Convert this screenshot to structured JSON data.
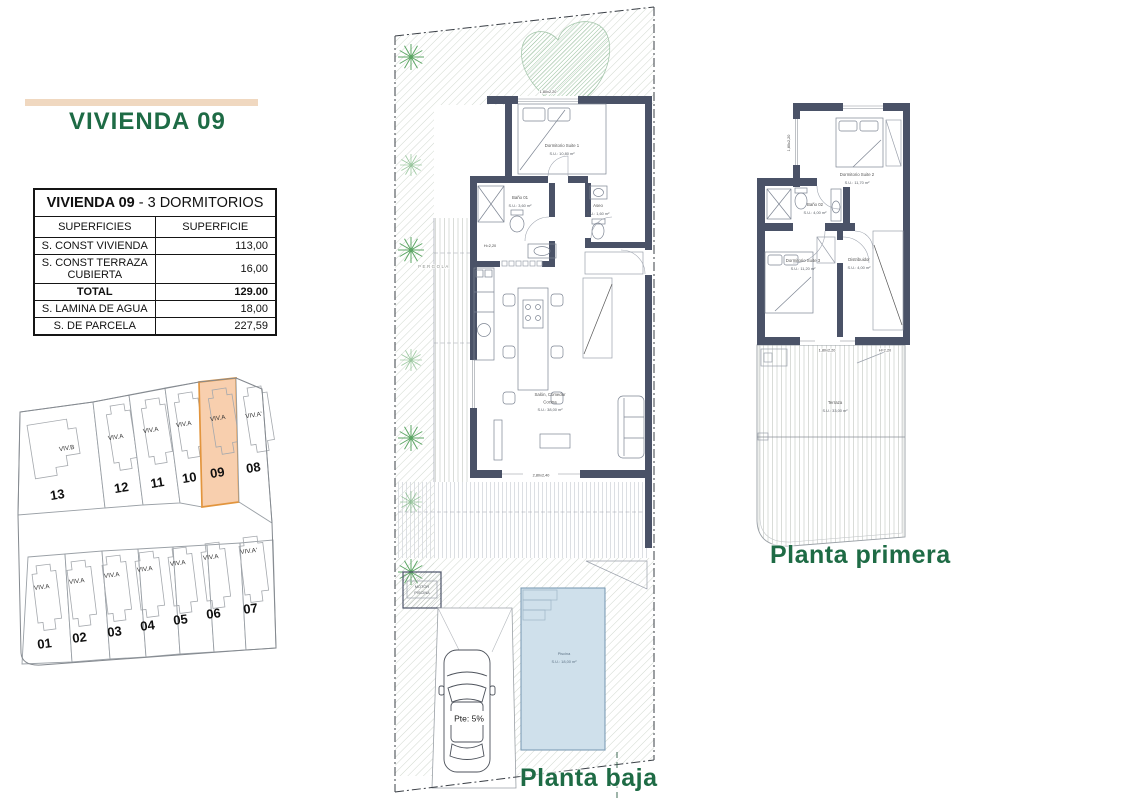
{
  "header": {
    "title": "VIVIENDA 09"
  },
  "table": {
    "title": {
      "bold": "VIVIENDA 09",
      "rest": " - 3 DORMITORIOS"
    },
    "columns": [
      "SUPERFICIES",
      "SUPERFICIE"
    ],
    "rows": [
      {
        "label": "S. CONST VIVIENDA",
        "value": "113,00",
        "bold": false
      },
      {
        "label": "S. CONST TERRAZA CUBIERTA",
        "value": "16,00",
        "bold": false
      },
      {
        "label": "TOTAL",
        "value": "129.00",
        "bold": true
      },
      {
        "label": "S. LAMINA DE AGUA",
        "value": "18,00",
        "bold": false
      },
      {
        "label": "S. DE PARCELA",
        "value": "227,59",
        "bold": false
      }
    ]
  },
  "site_plan": {
    "highlighted": "09",
    "top_row": [
      {
        "num": "13",
        "type": "VIV.B"
      },
      {
        "num": "12",
        "type": "VIV.A"
      },
      {
        "num": "11",
        "type": "VIV.A"
      },
      {
        "num": "10",
        "type": "VIV.A"
      },
      {
        "num": "09",
        "type": "VIV.A"
      },
      {
        "num": "08",
        "type": "VIV.A'"
      }
    ],
    "bottom_row": [
      {
        "num": "01",
        "type": "VIV.A"
      },
      {
        "num": "02",
        "type": "VIV.A"
      },
      {
        "num": "03",
        "type": "VIV.A"
      },
      {
        "num": "04",
        "type": "VIV.A"
      },
      {
        "num": "05",
        "type": "VIV.A"
      },
      {
        "num": "06",
        "type": "VIV.A"
      },
      {
        "num": "07",
        "type": "VIV.A'"
      }
    ]
  },
  "planta_baja": {
    "label": "Planta baja",
    "rooms": {
      "suite1": {
        "name": "Dormitorio Suite 1",
        "area": "S.U.: 10,80 m²"
      },
      "bano1": {
        "name": "Baño 01",
        "area": "S.U.: 3,60 m²"
      },
      "aseo": {
        "name": "Aseo",
        "area": "S.U.: 1,60 m²"
      },
      "salon": {
        "line1": "Salón, Comedor",
        "line2": "Cocina",
        "area": "S.U.: 38,00 m²"
      },
      "piscina": {
        "name": "Piscina",
        "area": "S.U.: 18,00 m²"
      }
    },
    "annotations": {
      "pergola": "PERGOLA",
      "motor_line1": "MOTOR",
      "motor_line2": "PISCINA",
      "slope": "Pte: 5%",
      "window_top": "1,80x2,20",
      "window_bottom": "2,80x2,40",
      "height": "H=2,20"
    }
  },
  "planta_primera": {
    "label": "Planta primera",
    "rooms": {
      "suite2": {
        "name": "Dormitorio Suite 2",
        "area": "S.U.: 11,70 m²"
      },
      "bano2": {
        "name": "Baño 02",
        "area": "S.U.: 4,00 m²"
      },
      "suite3": {
        "name": "Dormitorio Suite 3",
        "area": "S.U.: 11,20 m²"
      },
      "distribuidor": {
        "name": "Distribuidor",
        "area": "S.U.: 4,00 m²"
      },
      "terraza": {
        "name": "Terraza",
        "area": "S.U.: 33,00 m²"
      }
    },
    "annotations": {
      "window_left": "1,80x2,20",
      "window_bottom": "1,80x2,20",
      "height": "H=2,20"
    }
  },
  "colors": {
    "accent_green": "#1e6b45",
    "header_bar_beige": "#f0d8c0",
    "highlight_plot_fill": "#f8cfae",
    "highlight_plot_stroke": "#e2953e",
    "wall": "#4a5267",
    "pool": "#cfe0eb"
  }
}
